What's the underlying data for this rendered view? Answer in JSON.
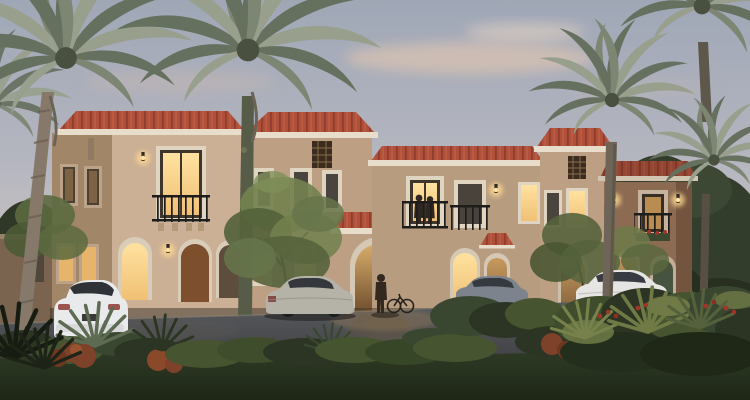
{
  "scene": {
    "title": "Twilight architectural rendering of Mediterranean-style townhouse villas",
    "time_of_day": "dusk",
    "style": "Spanish / Mediterranean residential architecture",
    "buildings": {
      "count": 4,
      "features": [
        "terracotta hip tile roofs",
        "beige stucco walls",
        "arched ground-floor openings",
        "juliet balconies with black wrought-iron railings",
        "decorative roof lattice vents",
        "lit wall sconces",
        "warm glowing windows",
        "wooden entry door",
        "green entry door",
        "gabled tile entrance canopy",
        "flower box under right balcony"
      ]
    },
    "vegetation": {
      "palm_trees": 6,
      "deciduous_trees": 3,
      "shrubs": "mixed green, olive, rust-red shrubs with red flower clusters and spiky agave plants",
      "lawn": "dark green foreground lawn"
    },
    "vehicles": {
      "count": 4,
      "list": [
        "white coupe, rear three-quarter view, parked left",
        "champagne-silver sedan, rear view, parked center",
        "grey sedan partially hidden behind shrubs, center-right",
        "white sedan, rear three-quarter view, parked right"
      ]
    },
    "people": {
      "count": 3,
      "list": [
        "two figures standing on a center balcony",
        "one person with a bicycle at the arched entrance"
      ]
    },
    "sky": "blue-grey dusk sky with soft pink clouds",
    "road": "dark asphalt driveway with warm light reflections"
  },
  "colors": {
    "sky_top": "#9fa7b6",
    "sky_mid": "#b6b7c0",
    "sky_low": "#cdc6bc",
    "sky_horizon": "#d4c9bb",
    "cloud_pink": "#d9c2b2",
    "cloud_cream": "#e6d3c3",
    "roof_tile": "#b0503a",
    "roof_tile_dark": "#8f3e2e",
    "roof_tile_light": "#c66a4e",
    "fascia": "#e8ddcb",
    "wall_light": "#ccb096",
    "wall_mid": "#bda084",
    "wall_shaded": "#a28668",
    "wall_brown": "#8d6b52",
    "wall_brown_dark": "#73543f",
    "trim": "#e0d5c1",
    "window_dark": "#453e35",
    "window_lit": "#f0c074",
    "glow": "#ffd98f",
    "door_wood": "#7d4f2c",
    "door_green": "#46543f",
    "iron": "#1f1d1b",
    "palm_frond": "#66705f",
    "palm_frond_light": "#98a08d",
    "palm_frond_mid": "#7d8573",
    "palm_trunk": "#86796a",
    "palm_trunk_dark": "#5e574c",
    "vine_trunk": "#565c48",
    "tree_olive": "#73814e",
    "tree_olive_dark": "#55633c",
    "backdrop_trees": "#333d2b",
    "backdrop_trees_dark": "#272f20",
    "road_top": "#5a5c60",
    "road_bottom": "#393b3f",
    "lawn_top": "#33402a",
    "lawn_bottom": "#1e2616",
    "shrub": "#46552f",
    "shrub_olive": "#6f7b46",
    "shrub_rust": "#7e422a",
    "flower_red": "#a23527",
    "car_white": "#e9eaec",
    "car_silver": "#b5b2a8",
    "car_grey": "#7d838c",
    "car_glass": "#343a40",
    "wheel": "#1b1d1f"
  }
}
